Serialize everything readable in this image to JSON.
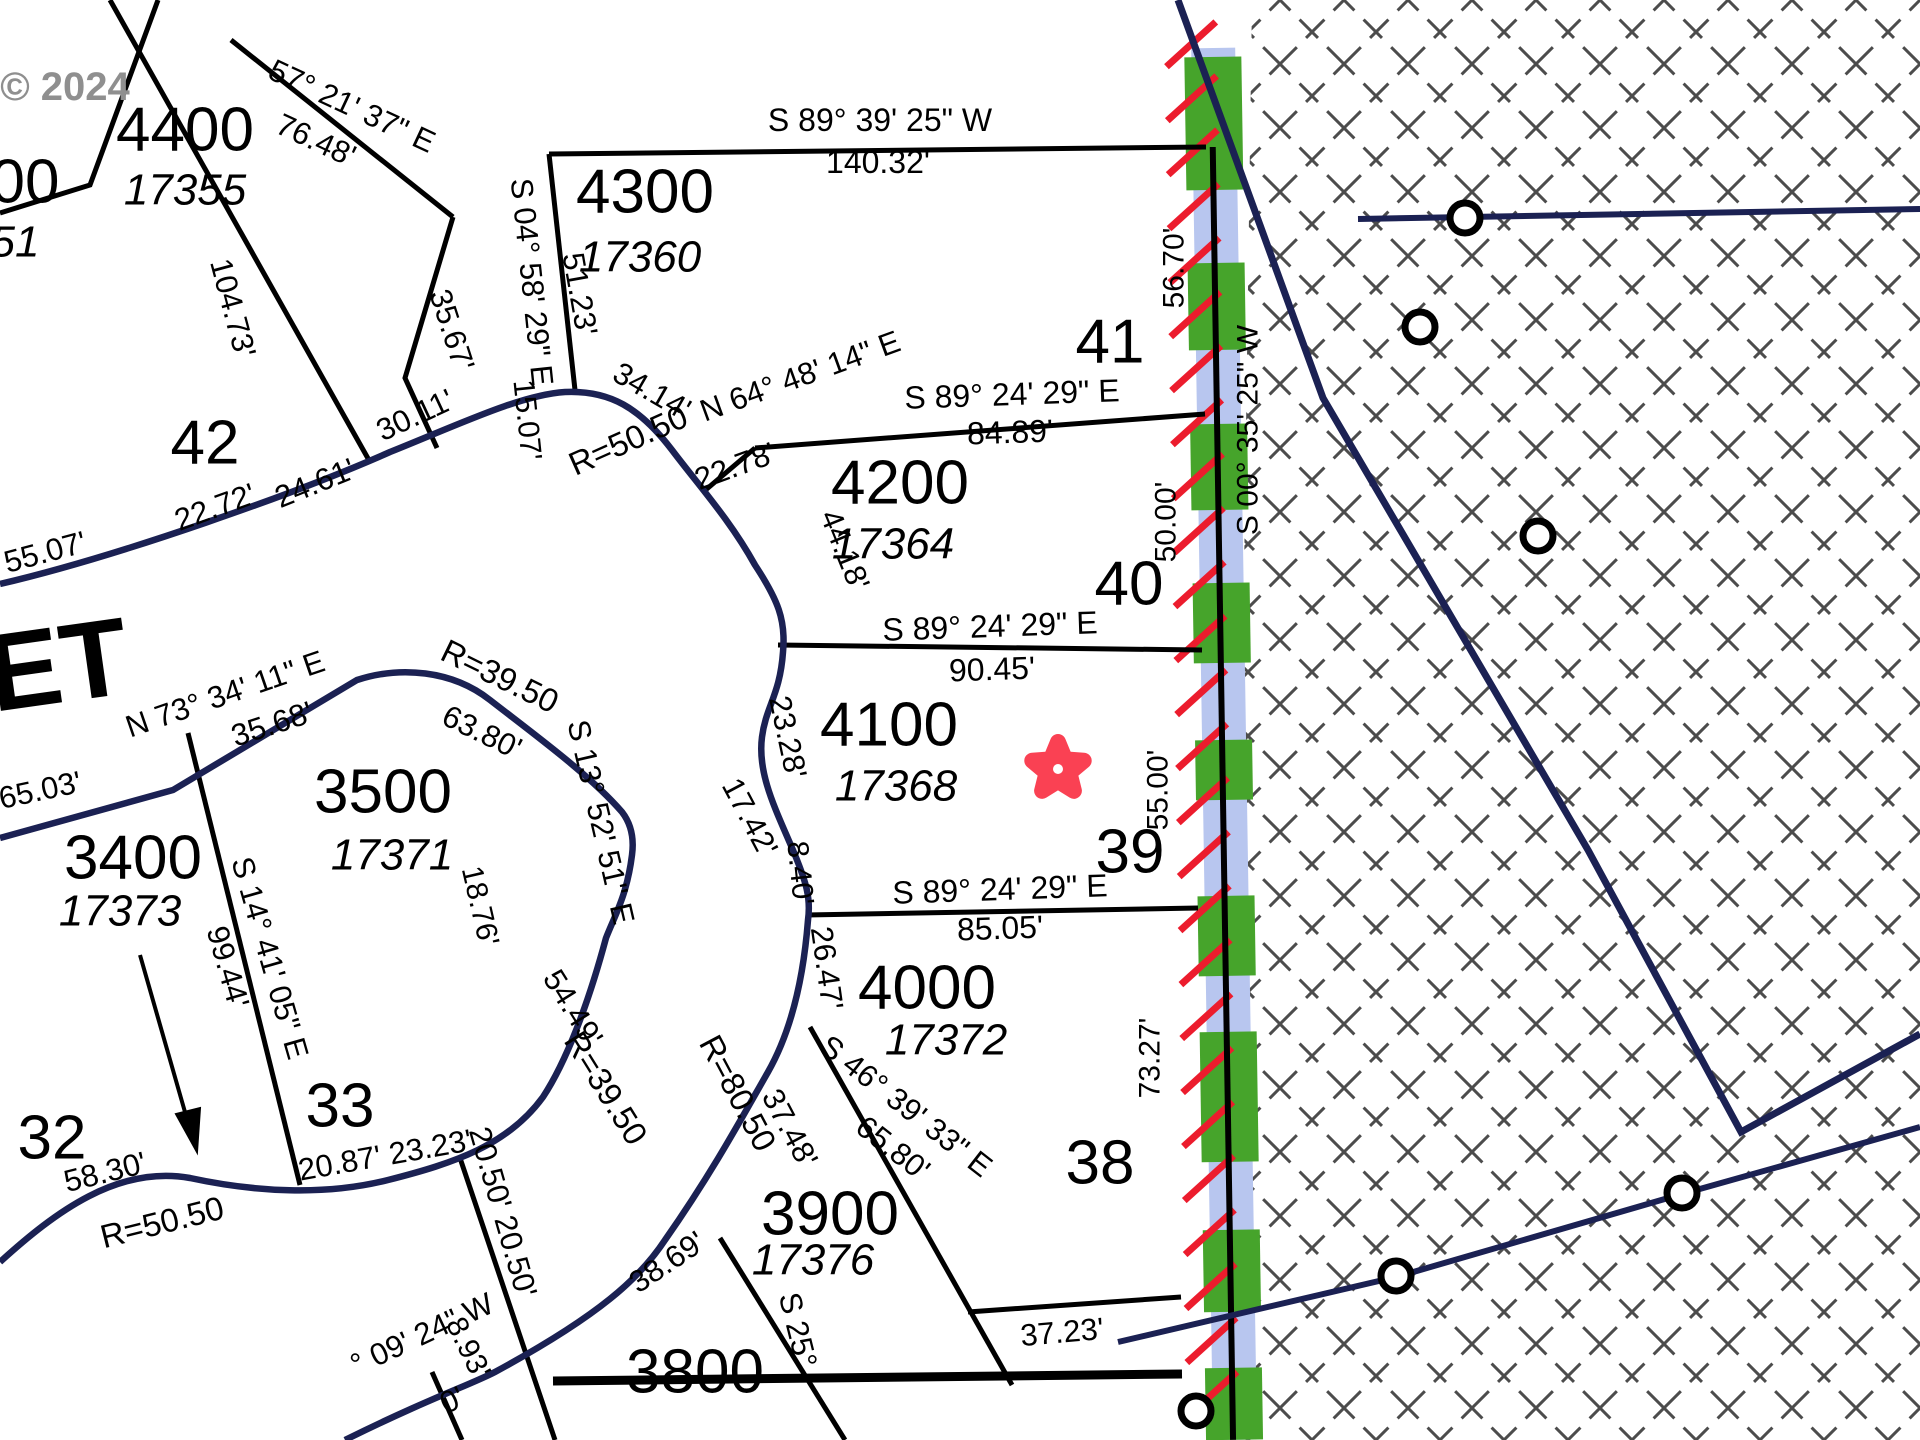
{
  "map": {
    "width": 1920,
    "height": 1440,
    "background": "#ffffff"
  },
  "colors": {
    "black": "#000000",
    "navy": "#1b2153",
    "green": "#46a42b",
    "blue_stripe": "#b8c6ef",
    "red_hatch": "#ec1c2d",
    "cross_hatch": "#4c4c4c",
    "star": "#fa4153",
    "watermark": "#8f8f8f"
  },
  "watermark": {
    "text": "© 2024",
    "x": 65,
    "y": 87,
    "size": 40
  },
  "crosshatch": {
    "poly": "M1252,0 L1920,0 L1920,1440 L1232,1440 Z",
    "tile": 64,
    "stroke_w": 3,
    "dash": "26 13"
  },
  "band": {
    "rotate": -0.9,
    "pivot_x": 1212,
    "pivot_y": 100,
    "blue": {
      "x": 1192,
      "y": 48,
      "w": 44,
      "h": 1392
    },
    "green_x": 1185,
    "green_w": 57,
    "green_segments": [
      [
        57,
        190
      ],
      [
        263,
        350
      ],
      [
        424,
        510
      ],
      [
        583,
        663
      ],
      [
        740,
        800
      ],
      [
        896,
        976
      ],
      [
        1032,
        1162
      ],
      [
        1230,
        1312
      ],
      [
        1368,
        1440
      ]
    ],
    "red_hatch": {
      "x1": 1167,
      "x2": 1217,
      "rise": 44,
      "y_start": 66,
      "y_end": 1440,
      "step": 54,
      "w": 7
    },
    "vline": {
      "x": 1212,
      "y1": 147,
      "y2": 1440,
      "w": 6
    }
  },
  "lines": [
    {
      "n": "parcel-line-corner-00",
      "d": "M0,213 L90,185 L158,0",
      "c": "black",
      "w": 5
    },
    {
      "n": "parcel-line-104-73",
      "d": "M110,0 L370,462",
      "c": "black",
      "w": 5
    },
    {
      "n": "parcel-line-4400-northeast",
      "d": "M231,40 L453,217",
      "c": "black",
      "w": 5
    },
    {
      "n": "parcel-line-4400-west",
      "d": "M453,217 L405,378 L437,448",
      "c": "black",
      "w": 5
    },
    {
      "n": "parcel-line-4300-west",
      "d": "M549,154 L575,390",
      "c": "black",
      "w": 5
    },
    {
      "n": "parcel-line-140-32",
      "d": "M549,154 L1206,147",
      "c": "black",
      "w": 5
    },
    {
      "n": "parcel-line-n64",
      "d": "M702,493 L755,448",
      "c": "black",
      "w": 5
    },
    {
      "n": "parcel-line-84-89",
      "d": "M755,448 L1205,414",
      "c": "black",
      "w": 5
    },
    {
      "n": "parcel-line-90-45",
      "d": "M778,645 L1202,650",
      "c": "black",
      "w": 5
    },
    {
      "n": "parcel-line-85-05",
      "d": "M806,915 L1198,908",
      "c": "black",
      "w": 5
    },
    {
      "n": "parcel-line-s46",
      "d": "M810,1027 L1012,1385",
      "c": "black",
      "w": 5
    },
    {
      "n": "parcel-line-37-23",
      "d": "M968,1312 L1181,1297",
      "c": "black",
      "w": 5
    },
    {
      "n": "parcel-line-s25",
      "d": "M720,1238 L845,1440",
      "c": "black",
      "w": 5
    },
    {
      "n": "parcel-line-3800",
      "d": "M553,1381 L1182,1374",
      "c": "black",
      "w": 9
    },
    {
      "n": "parcel-line-20-50",
      "d": "M460,1158 L555,1440",
      "c": "black",
      "w": 5
    },
    {
      "n": "parcel-line-8-93",
      "d": "M432,1372 L462,1440",
      "c": "black",
      "w": 5
    },
    {
      "n": "parcel-line-s14",
      "d": "M188,733 L300,1185",
      "c": "black",
      "w": 5
    },
    {
      "n": "arrow-line-3400",
      "d": "M140,955 L193,1140",
      "c": "black",
      "w": 4
    },
    {
      "n": "arrow-head-3400",
      "d": "M197,1152 L176,1114 L200,1108 Z",
      "c": "black",
      "w": 2,
      "fill": true
    },
    {
      "n": "road-edge-outer",
      "d": "M0,584 C120,556 300,492 390,452 C460,424 520,395 565,392 C610,390 640,408 672,450 C700,487 730,520 755,565 C778,600 786,620 783,652 C780,695 766,706 762,737 C757,775 777,812 795,855 C806,882 811,898 808,920 C803,985 789,1035 768,1072 C745,1112 714,1170 665,1240 C640,1278 600,1315 495,1372 C470,1385 430,1398 345,1440",
      "c": "navy",
      "w": 6.5
    },
    {
      "n": "road-edge-inner",
      "d": "M0,838 L173,790 L357,680 C400,666 452,670 490,700 C535,735 590,775 622,812 C632,825 634,840 632,855 C627,895 615,915 606,938 C588,1005 566,1062 543,1097 C508,1145 455,1163 388,1180 C325,1196 255,1192 190,1178 C118,1165 55,1212 0,1262",
      "c": "navy",
      "w": 6.5
    },
    {
      "n": "boundary-diagonal",
      "d": "M1178,0 L1323,398 L1588,850 L1741,1132 L1920,1034",
      "c": "navy",
      "w": 7
    },
    {
      "n": "boundary-north-horizontal",
      "d": "M1358,219 L1920,209",
      "c": "navy",
      "w": 6
    },
    {
      "n": "boundary-south-lower",
      "d": "M1118,1342 L1396,1277 L1682,1194 L1920,1127",
      "c": "navy",
      "w": 6
    }
  ],
  "circles": [
    {
      "n": "monument-circle-1",
      "x": 1465,
      "y": 218,
      "r": 15
    },
    {
      "n": "monument-circle-2",
      "x": 1420,
      "y": 327,
      "r": 15
    },
    {
      "n": "monument-circle-3",
      "x": 1538,
      "y": 536,
      "r": 15
    },
    {
      "n": "monument-circle-4",
      "x": 1396,
      "y": 1276,
      "r": 15
    },
    {
      "n": "monument-circle-5",
      "x": 1682,
      "y": 1193,
      "r": 15
    },
    {
      "n": "monument-circle-6",
      "x": 1196,
      "y": 1411,
      "r": 15
    }
  ],
  "star": {
    "cx": 1058,
    "cy": 769,
    "outer_r": 27,
    "inner_r": 12,
    "rot": -90,
    "stroke_w": 16,
    "dot_r": 5
  },
  "labels": [
    {
      "n": "watermark-2024",
      "t": "© 2024",
      "x": 65,
      "y": 87,
      "r": 0,
      "s": 40,
      "st": "b",
      "c": "#8f8f8f"
    },
    {
      "n": "lot-00",
      "t": "00",
      "x": 25,
      "y": 182,
      "r": 0,
      "s": 62
    },
    {
      "n": "addr-51",
      "t": "51",
      "x": 15,
      "y": 242,
      "r": 0,
      "s": 44,
      "st": "i"
    },
    {
      "n": "lot-4400",
      "t": "4400",
      "x": 185,
      "y": 130,
      "r": 0,
      "s": 62
    },
    {
      "n": "addr-17355",
      "t": "17355",
      "x": 185,
      "y": 190,
      "r": 0,
      "s": 44,
      "st": "i"
    },
    {
      "n": "dist-104-73",
      "t": "104.73'",
      "x": 233,
      "y": 308,
      "r": 75,
      "s": 31
    },
    {
      "n": "lot-42",
      "t": "42",
      "x": 205,
      "y": 443,
      "r": 0,
      "s": 62
    },
    {
      "n": "bearing-57-21-37",
      "t": "57° 21' 37\" E",
      "x": 352,
      "y": 106,
      "r": 25,
      "s": 31
    },
    {
      "n": "dist-76-48",
      "t": "76.48'",
      "x": 316,
      "y": 140,
      "r": 25,
      "s": 31
    },
    {
      "n": "dist-35-67",
      "t": "35.67'",
      "x": 452,
      "y": 330,
      "r": 72,
      "s": 31
    },
    {
      "n": "bearing-s04-58-29",
      "t": "S 04° 58' 29\" E",
      "x": 532,
      "y": 282,
      "r": 84,
      "s": 31
    },
    {
      "n": "dist-51-23",
      "t": "51.23'",
      "x": 580,
      "y": 294,
      "r": 80,
      "s": 31
    },
    {
      "n": "dist-15-07",
      "t": "15.07'",
      "x": 527,
      "y": 420,
      "r": 84,
      "s": 30
    },
    {
      "n": "lot-4300",
      "t": "4300",
      "x": 645,
      "y": 192,
      "r": 0,
      "s": 62
    },
    {
      "n": "addr-17360",
      "t": "17360",
      "x": 640,
      "y": 257,
      "r": 0,
      "s": 44,
      "st": "i"
    },
    {
      "n": "bearing-s89-39-25",
      "t": "S 89° 39' 25\" W",
      "x": 880,
      "y": 120,
      "r": 0,
      "s": 32
    },
    {
      "n": "dist-140-32",
      "t": "140.32'",
      "x": 878,
      "y": 162,
      "r": 0,
      "s": 32
    },
    {
      "n": "dist-34-14",
      "t": "34.14'",
      "x": 652,
      "y": 391,
      "r": 30,
      "s": 31
    },
    {
      "n": "radius-50-50-top",
      "t": "R=50.50",
      "x": 628,
      "y": 440,
      "r": -24,
      "s": 33
    },
    {
      "n": "bearing-n64-48-14",
      "t": "N 64° 48' 14\" E",
      "x": 800,
      "y": 376,
      "r": -20,
      "s": 31
    },
    {
      "n": "dist-22-78",
      "t": "22.78'",
      "x": 735,
      "y": 466,
      "r": -20,
      "s": 31
    },
    {
      "n": "lot-41",
      "t": "41",
      "x": 1110,
      "y": 342,
      "r": 0,
      "s": 62
    },
    {
      "n": "bearing-s89-24-29-a",
      "t": "S 89° 24' 29\" E",
      "x": 1012,
      "y": 394,
      "r": -2,
      "s": 32
    },
    {
      "n": "dist-84-89",
      "t": "84.89'",
      "x": 1010,
      "y": 432,
      "r": -2,
      "s": 32
    },
    {
      "n": "lot-4200",
      "t": "4200",
      "x": 900,
      "y": 483,
      "r": 0,
      "s": 62
    },
    {
      "n": "addr-17364",
      "t": "17364",
      "x": 893,
      "y": 544,
      "r": 0,
      "s": 44,
      "st": "i"
    },
    {
      "n": "dist-44-18",
      "t": "44.18'",
      "x": 845,
      "y": 550,
      "r": 68,
      "s": 31
    },
    {
      "n": "lot-40",
      "t": "40",
      "x": 1129,
      "y": 584,
      "r": 0,
      "s": 62
    },
    {
      "n": "dist-56-70",
      "t": "56.70'",
      "x": 1174,
      "y": 268,
      "r": -90,
      "s": 30
    },
    {
      "n": "dist-50-00",
      "t": "50.00'",
      "x": 1166,
      "y": 522,
      "r": -90,
      "s": 30
    },
    {
      "n": "bearing-s00-35-25",
      "t": "S 00° 35' 25\" W",
      "x": 1248,
      "y": 430,
      "r": -90,
      "s": 30
    },
    {
      "n": "bearing-s89-24-29-b",
      "t": "S 89° 24' 29\" E",
      "x": 990,
      "y": 626,
      "r": -2,
      "s": 32
    },
    {
      "n": "dist-90-45",
      "t": "90.45'",
      "x": 992,
      "y": 669,
      "r": -2,
      "s": 32
    },
    {
      "n": "lot-4100",
      "t": "4100",
      "x": 889,
      "y": 725,
      "r": 0,
      "s": 62
    },
    {
      "n": "addr-17368",
      "t": "17368",
      "x": 896,
      "y": 786,
      "r": 0,
      "s": 44,
      "st": "i"
    },
    {
      "n": "dist-23-28",
      "t": "23.28'",
      "x": 788,
      "y": 737,
      "r": 78,
      "s": 31
    },
    {
      "n": "dist-17-42",
      "t": "17.42'",
      "x": 750,
      "y": 817,
      "r": 62,
      "s": 31
    },
    {
      "n": "dist-8-40",
      "t": "8.40'",
      "x": 800,
      "y": 873,
      "r": 84,
      "s": 30
    },
    {
      "n": "lot-39",
      "t": "39",
      "x": 1130,
      "y": 852,
      "r": 0,
      "s": 62
    },
    {
      "n": "dist-55-00",
      "t": "55.00'",
      "x": 1158,
      "y": 790,
      "r": -90,
      "s": 30
    },
    {
      "n": "bearing-s89-24-29-c",
      "t": "S 89° 24' 29\" E",
      "x": 1000,
      "y": 889,
      "r": -2,
      "s": 32
    },
    {
      "n": "dist-85-05",
      "t": "85.05'",
      "x": 1000,
      "y": 928,
      "r": -2,
      "s": 32
    },
    {
      "n": "lot-4000",
      "t": "4000",
      "x": 927,
      "y": 988,
      "r": 0,
      "s": 62
    },
    {
      "n": "addr-17372",
      "t": "17372",
      "x": 946,
      "y": 1040,
      "r": 0,
      "s": 44,
      "st": "i"
    },
    {
      "n": "dist-26-47",
      "t": "26.47'",
      "x": 827,
      "y": 968,
      "r": 82,
      "s": 31
    },
    {
      "n": "bearing-s46-39-33",
      "t": "S 46° 39' 33\" E",
      "x": 906,
      "y": 1106,
      "r": 38,
      "s": 31
    },
    {
      "n": "dist-65-80",
      "t": "65.80'",
      "x": 893,
      "y": 1148,
      "r": 38,
      "s": 31
    },
    {
      "n": "lot-38",
      "t": "38",
      "x": 1100,
      "y": 1163,
      "r": 0,
      "s": 62
    },
    {
      "n": "dist-73-27",
      "t": "73.27'",
      "x": 1150,
      "y": 1058,
      "r": -90,
      "s": 30
    },
    {
      "n": "dist-37-23",
      "t": "37.23'",
      "x": 1062,
      "y": 1332,
      "r": -5,
      "s": 31
    },
    {
      "n": "lot-3900",
      "t": "3900",
      "x": 830,
      "y": 1214,
      "r": 0,
      "s": 62
    },
    {
      "n": "addr-17376",
      "t": "17376",
      "x": 813,
      "y": 1260,
      "r": 0,
      "s": 44,
      "st": "i"
    },
    {
      "n": "lot-3800",
      "t": "3800",
      "x": 695,
      "y": 1372,
      "r": 0,
      "s": 62
    },
    {
      "n": "bearing-s25",
      "t": "S 25°",
      "x": 798,
      "y": 1330,
      "r": 76,
      "s": 31
    },
    {
      "n": "radius-80-50",
      "t": "R=80.50",
      "x": 738,
      "y": 1093,
      "r": 62,
      "s": 33
    },
    {
      "n": "dist-37-48",
      "t": "37.48'",
      "x": 790,
      "y": 1128,
      "r": 62,
      "s": 31
    },
    {
      "n": "dist-54-49",
      "t": "54.49'",
      "x": 573,
      "y": 1008,
      "r": 58,
      "s": 31
    },
    {
      "n": "radius-39-50-bottom",
      "t": "R=39.50",
      "x": 606,
      "y": 1088,
      "r": 58,
      "s": 33
    },
    {
      "n": "dist-38-69",
      "t": "38.69'",
      "x": 667,
      "y": 1262,
      "r": -34,
      "s": 31
    },
    {
      "n": "dist-20-50-20-50",
      "t": "20.50' 20.50'",
      "x": 503,
      "y": 1212,
      "r": 74,
      "s": 31
    },
    {
      "n": "dist-8-93",
      "t": "8.93'",
      "x": 468,
      "y": 1348,
      "r": 64,
      "s": 30
    },
    {
      "n": "bearing-09-24",
      "t": "° 09' 24\" W",
      "x": 422,
      "y": 1334,
      "r": -25,
      "s": 31
    },
    {
      "n": "dist-frag-0",
      "t": "0'",
      "x": 452,
      "y": 1400,
      "r": -25,
      "s": 31
    },
    {
      "n": "street-name-et",
      "t": "ET",
      "x": 58,
      "y": 665,
      "r": -8,
      "s": 110,
      "st": "b"
    },
    {
      "n": "dist-55-07",
      "t": "55.07'",
      "x": 45,
      "y": 552,
      "r": -15,
      "s": 31
    },
    {
      "n": "dist-22-72",
      "t": "22.72'",
      "x": 215,
      "y": 507,
      "r": -20,
      "s": 31
    },
    {
      "n": "dist-24-61",
      "t": "24.61'",
      "x": 315,
      "y": 483,
      "r": -22,
      "s": 31
    },
    {
      "n": "dist-30-11",
      "t": "30.11'",
      "x": 415,
      "y": 415,
      "r": -25,
      "s": 31
    },
    {
      "n": "bearing-n73-34-11",
      "t": "N 73° 34' 11\" E",
      "x": 225,
      "y": 694,
      "r": -19,
      "s": 31
    },
    {
      "n": "dist-35-68",
      "t": "35.68'",
      "x": 272,
      "y": 724,
      "r": -18,
      "s": 31
    },
    {
      "n": "dist-65-03",
      "t": "65.03'",
      "x": 40,
      "y": 790,
      "r": -12,
      "s": 31
    },
    {
      "n": "lot-3500",
      "t": "3500",
      "x": 383,
      "y": 792,
      "r": 0,
      "s": 62
    },
    {
      "n": "addr-17371",
      "t": "17371",
      "x": 392,
      "y": 855,
      "r": 0,
      "s": 44,
      "st": "i"
    },
    {
      "n": "radius-39-50-top",
      "t": "R=39.50",
      "x": 500,
      "y": 676,
      "r": 26,
      "s": 33
    },
    {
      "n": "dist-63-80",
      "t": "63.80'",
      "x": 482,
      "y": 732,
      "r": 26,
      "s": 31
    },
    {
      "n": "bearing-s13-52-51",
      "t": "S 13° 52' 51\" E",
      "x": 601,
      "y": 822,
      "r": 77,
      "s": 31
    },
    {
      "n": "dist-18-76",
      "t": "18.76'",
      "x": 480,
      "y": 906,
      "r": 77,
      "s": 30
    },
    {
      "n": "lot-3400",
      "t": "3400",
      "x": 133,
      "y": 858,
      "r": 0,
      "s": 62
    },
    {
      "n": "addr-17373",
      "t": "17373",
      "x": 120,
      "y": 911,
      "r": 0,
      "s": 44,
      "st": "i"
    },
    {
      "n": "bearing-s14-41-05",
      "t": "S 14° 41' 05\" E",
      "x": 270,
      "y": 958,
      "r": 74,
      "s": 31
    },
    {
      "n": "dist-99-44",
      "t": "99.44'",
      "x": 228,
      "y": 967,
      "r": 74,
      "s": 31
    },
    {
      "n": "lot-32",
      "t": "32",
      "x": 52,
      "y": 1138,
      "r": 0,
      "s": 62
    },
    {
      "n": "lot-33",
      "t": "33",
      "x": 340,
      "y": 1106,
      "r": 0,
      "s": 62
    },
    {
      "n": "dist-58-30",
      "t": "58.30'",
      "x": 105,
      "y": 1172,
      "r": -14,
      "s": 31
    },
    {
      "n": "radius-50-50-bottom",
      "t": "R=50.50",
      "x": 162,
      "y": 1222,
      "r": -14,
      "s": 33
    },
    {
      "n": "dist-20-87-23-23",
      "t": "20.87' 23.23'",
      "x": 385,
      "y": 1155,
      "r": -10,
      "s": 31
    }
  ]
}
